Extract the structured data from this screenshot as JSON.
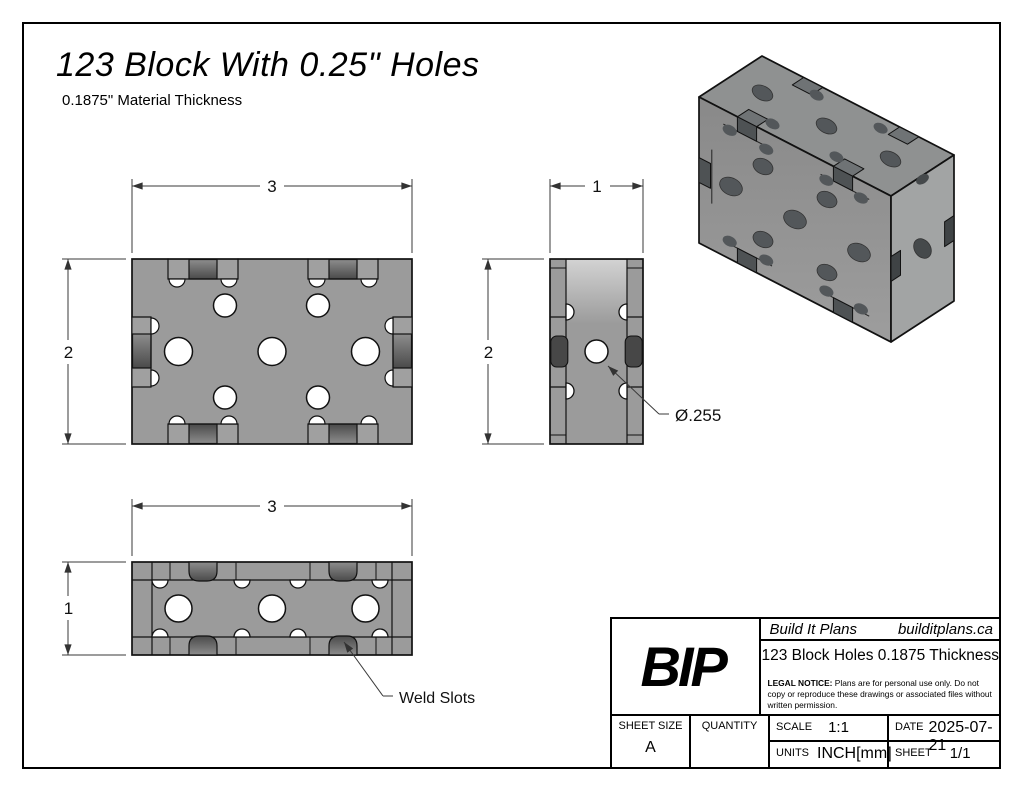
{
  "page": {
    "title": "123 Block With 0.25\" Holes",
    "subtitle": "0.1875\" Material Thickness"
  },
  "views": {
    "front": {
      "width_dim": "3",
      "height_dim": "2"
    },
    "side": {
      "width_dim": "1",
      "height_dim": "2",
      "hole_label": "Ø.255"
    },
    "top": {
      "width_dim": "3",
      "height_dim": "1",
      "slot_label": "Weld Slots"
    }
  },
  "title_block": {
    "logo": "BIP",
    "company": "Build It Plans",
    "website": "builditplans.ca",
    "drawing_title": "123 Block Holes 0.1875 Thickness",
    "legal_bold": "LEGAL NOTICE:",
    "legal_text": " Plans are for personal use only. Do not copy or reproduce these drawings or associated files without written permission.",
    "sheet_size_label": "SHEET SIZE",
    "sheet_size": "A",
    "quantity_label": "QUANTITY",
    "scale_label": "SCALE",
    "scale": "1:1",
    "date_label": "DATE",
    "date": "2025-07-21",
    "units_label": "UNITS",
    "units": "INCH[mm]",
    "sheet_label": "SHEET",
    "sheet": "1/1"
  },
  "colors": {
    "ink": "#111111",
    "dim_line": "#3a3a3a",
    "body_gray": "#9b9b9b",
    "recess_gray": "#a0a0a0",
    "slot_dark": "#4a4a4a",
    "hole_white": "#ffffff",
    "iso_top": "#8f9191",
    "iso_front": "#949494",
    "iso_right": "#a2a4a4",
    "iso_hole": "#53575a"
  }
}
